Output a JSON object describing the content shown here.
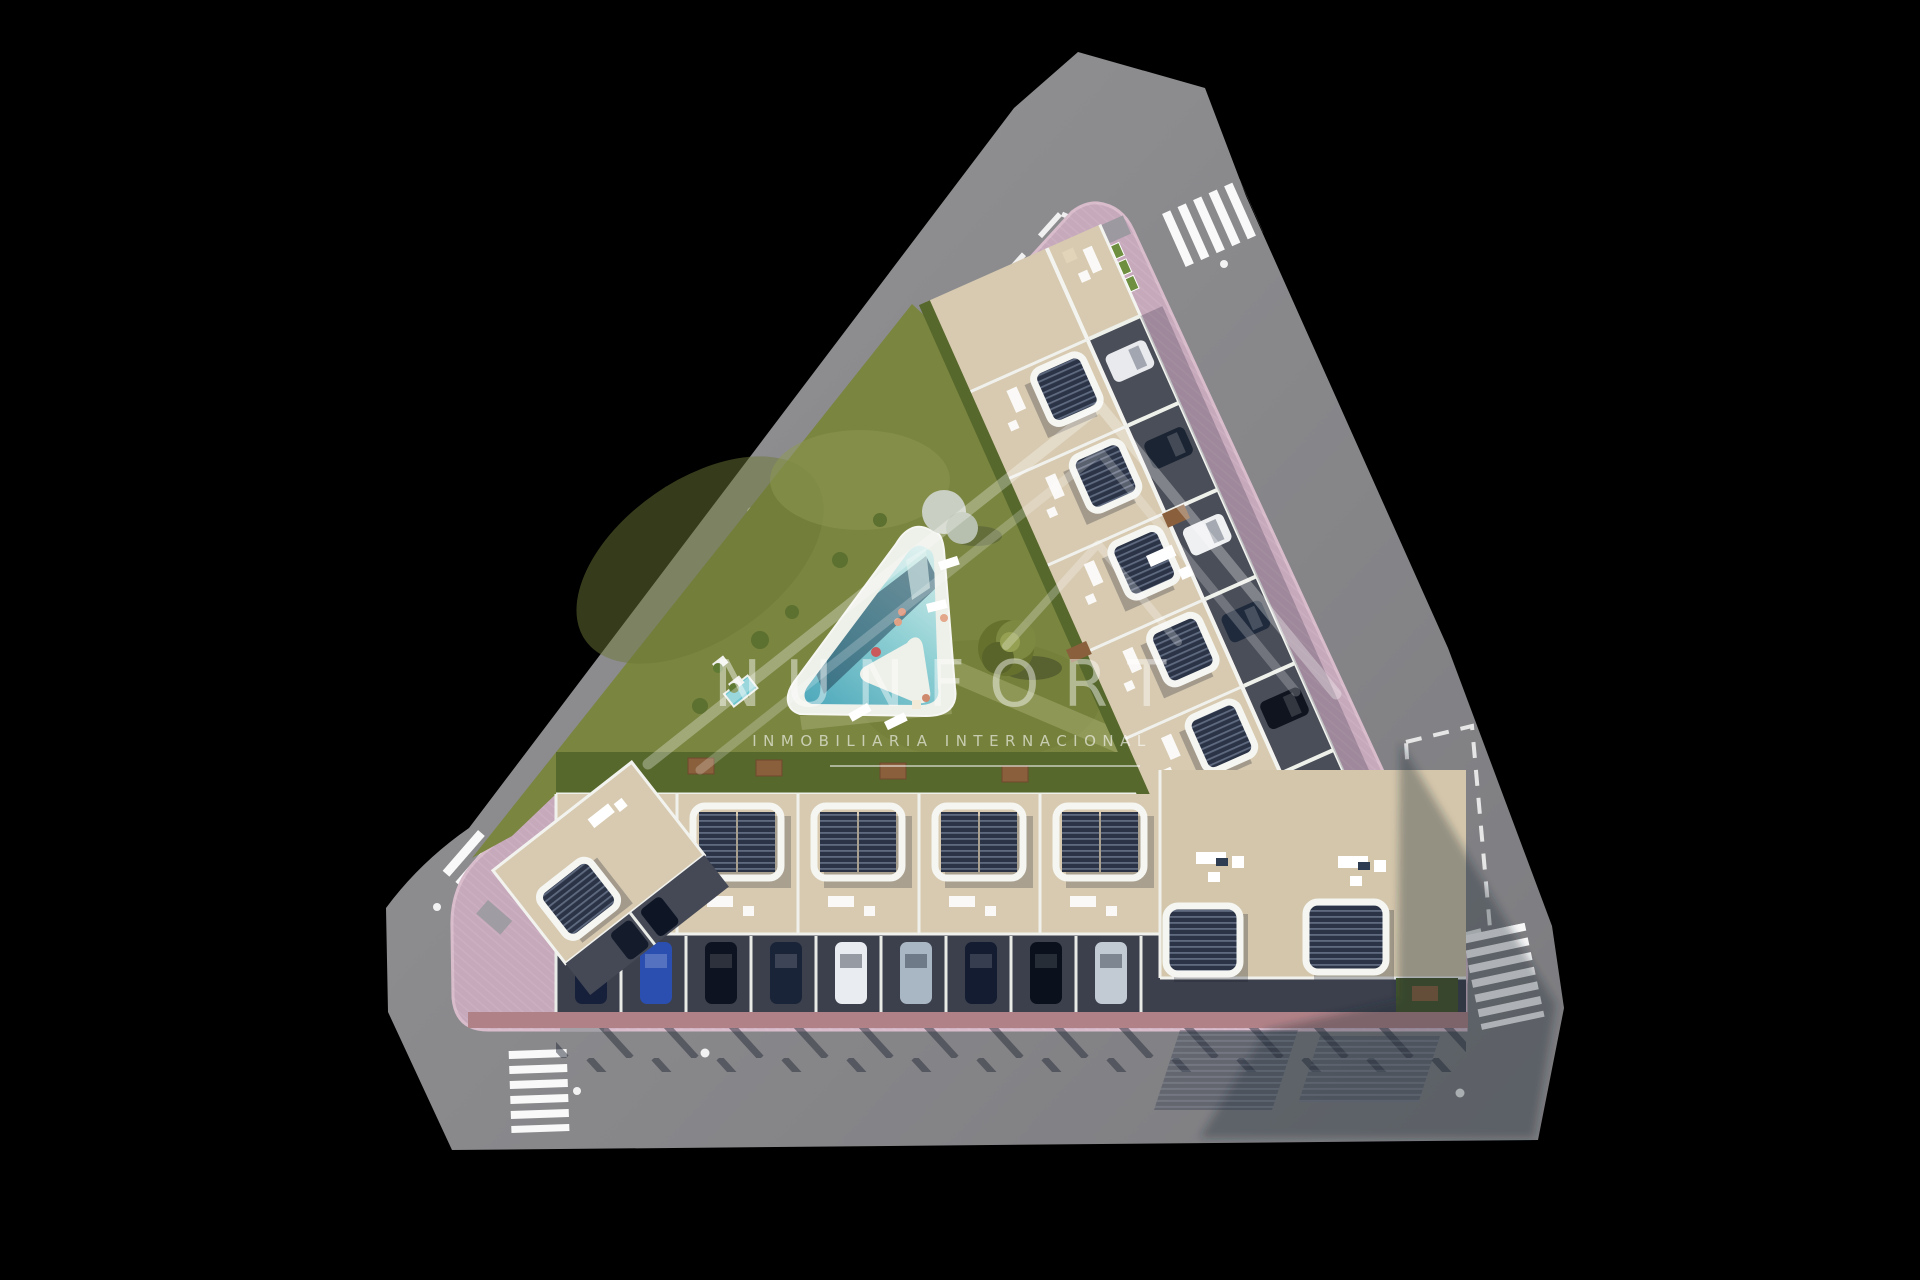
{
  "watermark": {
    "brand": "NUNFORT",
    "tagline": "INMOBILIARIA INTERNACIONAL",
    "logo": "mountain-peaks-outline"
  },
  "palette": {
    "background": "#000000",
    "road": "#8a8a8c",
    "road_shadow": "#26283a",
    "sidewalk_pink": "#c7a9bc",
    "sidewalk_brick": "#b08287",
    "lawn": "#7a8540",
    "hedge": "#57682c",
    "terrace_beige": "#d7cab0",
    "wall_white": "#f5f6f2",
    "pergola_dark": "#2b3446",
    "garage_asphalt": "#3c404c",
    "pool_light": "#d2ecea",
    "pool_deep": "#4fa9bb",
    "pool_shadow": "#23435a",
    "crosswalk_white": "#ffffff"
  },
  "scene": {
    "description": "Aerial 3D render of a triangular residential block with a central lawn and triangular pool, surrounded by grey streets on black background",
    "crosswalks": [
      {
        "position": "north-east"
      },
      {
        "position": "south-east"
      },
      {
        "position": "south"
      },
      {
        "position": "west"
      }
    ],
    "road_markings": [
      "dashed-center-line",
      "dashed-parking-bay-outline",
      "reflector-dots"
    ],
    "pool": {
      "shape": "triangular",
      "water_light": "#d2ecea",
      "water_deep": "#4fa9bb"
    },
    "parking": {
      "south_row_bays": 9,
      "east_row_driveways": 5
    },
    "car_colors": [
      "navy",
      "blue",
      "black",
      "white",
      "silver"
    ],
    "amenities": [
      "sun-loungers",
      "picnic-tables",
      "rooftop-pergolas",
      "outdoor-sofas",
      "planters",
      "trees"
    ]
  }
}
